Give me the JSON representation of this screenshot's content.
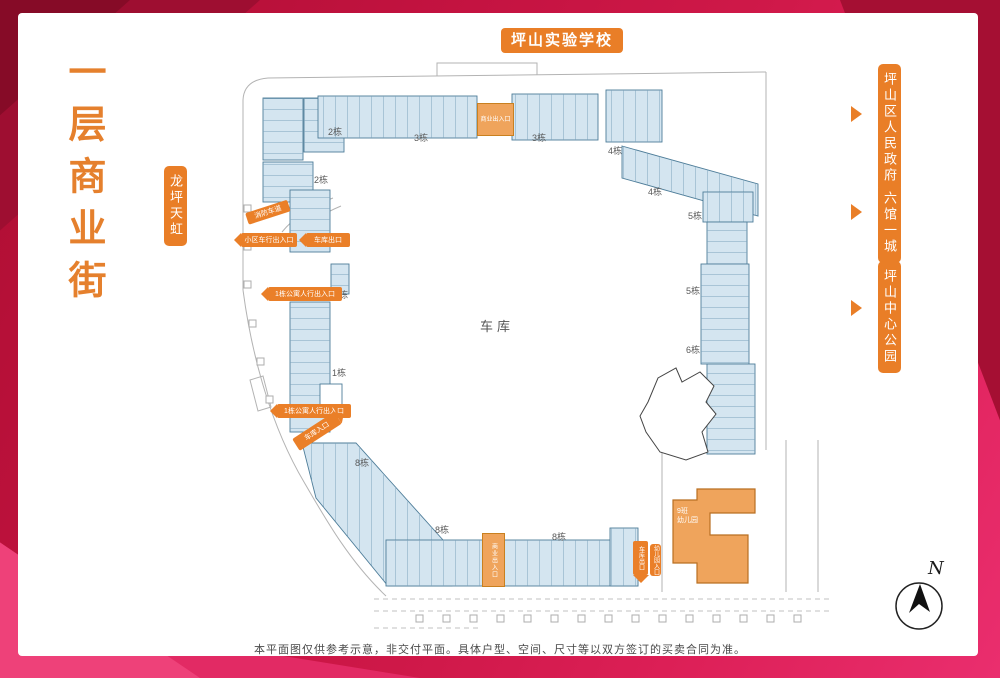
{
  "title": {
    "text": "一层商业街"
  },
  "landmarks": {
    "top": "坪山实验学校",
    "left": "龙坪天虹",
    "right": [
      {
        "label": "坪山区人民政府"
      },
      {
        "label": "六馆一城"
      },
      {
        "label": "坪山中心公园"
      }
    ]
  },
  "plan": {
    "center_label": "车库",
    "kindergarten": {
      "line1": "9班",
      "line2": "幼儿园"
    },
    "north_label": "N",
    "building_labels": [
      {
        "text": "2栋",
        "x": 328,
        "y": 128
      },
      {
        "text": "2栋",
        "x": 314,
        "y": 176
      },
      {
        "text": "3栋",
        "x": 414,
        "y": 134
      },
      {
        "text": "3栋",
        "x": 532,
        "y": 134
      },
      {
        "text": "4栋",
        "x": 608,
        "y": 147
      },
      {
        "text": "4栋",
        "x": 648,
        "y": 188
      },
      {
        "text": "5栋",
        "x": 688,
        "y": 212
      },
      {
        "text": "5栋",
        "x": 686,
        "y": 287
      },
      {
        "text": "6栋",
        "x": 686,
        "y": 346
      },
      {
        "text": "1栋",
        "x": 334,
        "y": 291
      },
      {
        "text": "1栋",
        "x": 332,
        "y": 369
      },
      {
        "text": "8栋",
        "x": 355,
        "y": 459
      },
      {
        "text": "8栋",
        "x": 435,
        "y": 526
      },
      {
        "text": "8栋",
        "x": 552,
        "y": 533
      }
    ],
    "entrances": [
      {
        "kind": "block",
        "text": "商业出入口",
        "x": 477,
        "y": 103,
        "w": 35,
        "h": 31,
        "vert": false
      },
      {
        "kind": "block",
        "text": "商业出入口",
        "x": 482,
        "y": 533,
        "w": 21,
        "h": 52,
        "vert": true
      },
      {
        "kind": "label",
        "text": "消防车道",
        "x": 247,
        "y": 213,
        "w": 44,
        "h": 12,
        "rot": -18
      },
      {
        "kind": "arrow-left",
        "text": "小区车行出入口",
        "x": 241,
        "y": 233,
        "w": 56,
        "h": 14
      },
      {
        "kind": "arrow-left",
        "text": "车库出口",
        "x": 306,
        "y": 233,
        "w": 44,
        "h": 14
      },
      {
        "kind": "arrow-left",
        "text": "1栋公寓人行出入口",
        "x": 268,
        "y": 287,
        "w": 74,
        "h": 14
      },
      {
        "kind": "arrow-left",
        "text": "1栋公寓人行出入口",
        "x": 277,
        "y": 404,
        "w": 74,
        "h": 14
      },
      {
        "kind": "arrow-right",
        "text": "车库入口",
        "x": 296,
        "y": 438,
        "w": 50,
        "h": 14,
        "rot": -33
      },
      {
        "kind": "arrow-down",
        "text": "车库出口",
        "x": 633,
        "y": 541,
        "w": 15,
        "h": 34
      },
      {
        "kind": "badge-v",
        "text": "幼儿园入口",
        "x": 650,
        "y": 544,
        "w": 11,
        "h": 32
      }
    ]
  },
  "plan_geometry": {
    "solid_paths": [
      "M268 78 L766 72",
      "M766 72 L766 450",
      "M268 78 Q244 80 243 100 L243 290",
      "M243 290 C252 358 272 428 304 482 C326 520 350 562 386 596",
      "M437 76 L437 63 L537 63 L537 75",
      "M662 452 L662 592",
      "M786 440 L786 592",
      "M818 440 L818 592",
      "M333 198 Q300 210 282 232",
      "M341 206 Q312 218 291 239",
      "M250 380 L263 376 L271 407 L258 411 Z"
    ],
    "dashed_paths": [
      "M374 599 L830 599",
      "M374 611 L830 611",
      "M374 628 L480 628"
    ],
    "road_squares": {
      "x_start": 416,
      "step": 27,
      "count": 15,
      "y": 615,
      "size": 7
    },
    "left_squares": [
      [
        244,
        205
      ],
      [
        244,
        243
      ],
      [
        244,
        281
      ],
      [
        249,
        320
      ],
      [
        257,
        358
      ],
      [
        266,
        396
      ]
    ],
    "shops": [
      {
        "x": 263,
        "y": 98,
        "w": 40,
        "h": 62,
        "dir": "h"
      },
      {
        "x": 263,
        "y": 162,
        "w": 50,
        "h": 40,
        "dir": "h"
      },
      {
        "x": 304,
        "y": 98,
        "w": 40,
        "h": 54,
        "dir": "h"
      },
      {
        "x": 318,
        "y": 96,
        "w": 159,
        "h": 42,
        "dir": "v"
      },
      {
        "x": 512,
        "y": 94,
        "w": 86,
        "h": 46,
        "dir": "v"
      },
      {
        "x": 606,
        "y": 90,
        "w": 56,
        "h": 52,
        "dir": "v"
      },
      {
        "points": "622,146 758,184 758,216 622,178",
        "dir": "v"
      },
      {
        "x": 703,
        "y": 192,
        "w": 50,
        "h": 30,
        "dir": "v"
      },
      {
        "x": 707,
        "y": 222,
        "w": 40,
        "h": 42,
        "dir": "h"
      },
      {
        "x": 701,
        "y": 264,
        "w": 48,
        "h": 100,
        "dir": "h"
      },
      {
        "x": 707,
        "y": 364,
        "w": 48,
        "h": 90,
        "dir": "h"
      },
      {
        "x": 290,
        "y": 190,
        "w": 40,
        "h": 62,
        "dir": "h"
      },
      {
        "x": 331,
        "y": 264,
        "w": 18,
        "h": 30,
        "dir": "h"
      },
      {
        "x": 290,
        "y": 302,
        "w": 40,
        "h": 130,
        "dir": "h"
      },
      {
        "x": 320,
        "y": 384,
        "w": 22,
        "h": 26,
        "dir": "h",
        "fill": "#ffffff"
      },
      {
        "points": "302,443 356,443 452,550 452,586 388,586 316,498",
        "dir": "v"
      },
      {
        "x": 386,
        "y": 540,
        "w": 252,
        "h": 46,
        "dir": "v"
      },
      {
        "x": 610,
        "y": 528,
        "w": 28,
        "h": 58,
        "dir": "v"
      }
    ],
    "white_building": "M648 402 L658 378 L676 368 L682 382 L700 372 L714 386 L706 402 L716 414 L702 432 L708 452 L686 460 L660 452 L646 432 L640 416 Z",
    "kindergarten": "M673 500 L697 500 L697 489 L755 489 L755 513 L710 513 L710 535 L748 535 L748 583 L697 583 L697 563 L673 563 Z"
  },
  "footer": {
    "disclaimer": "本平面图仅供参考示意，非交付平面。具体户型、空间、尺寸等以双方签订的买卖合同为准。"
  },
  "colors": {
    "accent_orange": "#e97e27",
    "shop_fill": "#d4e5f0",
    "shop_border": "#4e7d99",
    "kindergarten_fill": "#efa45c",
    "frame_red": "#c41341"
  }
}
